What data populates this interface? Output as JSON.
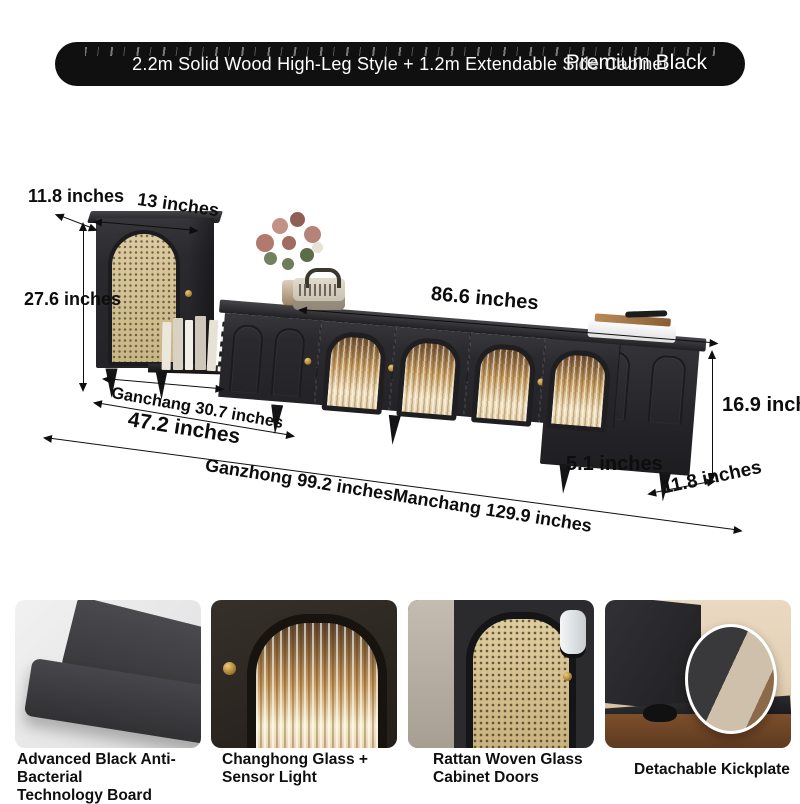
{
  "banner": {
    "title": "2.2m Solid Wood High-Leg Style + 1.2m Extendable Side Cabinet",
    "variant": "Premium Black",
    "bg_color": "#101010",
    "text_color": "#ffffff"
  },
  "dimensions": {
    "side_cabinet_depth": "11.8 inches",
    "side_cabinet_width": "13 inches",
    "side_cabinet_height": "27.6 inches",
    "tv_cabinet_length": "86.6 inches",
    "shelf_length": "Ganchang 30.7 inches",
    "left_section_length": "47.2 inches",
    "combined_length": "Ganzhong 99.2 inches",
    "full_length": "Manchang 129.9 inches",
    "end_cabinet_height": "16.9 inches",
    "leg_height": "5.1 inches",
    "end_cabinet_depth": "11.8 inches"
  },
  "features": [
    {
      "line1": "Advanced Black Anti-Bacterial",
      "line2": "Technology Board"
    },
    {
      "line1": "Changhong Glass +",
      "line2": "Sensor Light"
    },
    {
      "line1": "Rattan Woven Glass",
      "line2": "Cabinet Doors"
    },
    {
      "line1": "Detachable Kickplate",
      "line2": ""
    }
  ],
  "colors": {
    "furniture_black": "#2a2a2e",
    "rattan_beige": "#d8c49a",
    "glass_warm": "#e8c280",
    "gold_knob": "#b8860b",
    "dimension_text": "#0d0d0d"
  }
}
